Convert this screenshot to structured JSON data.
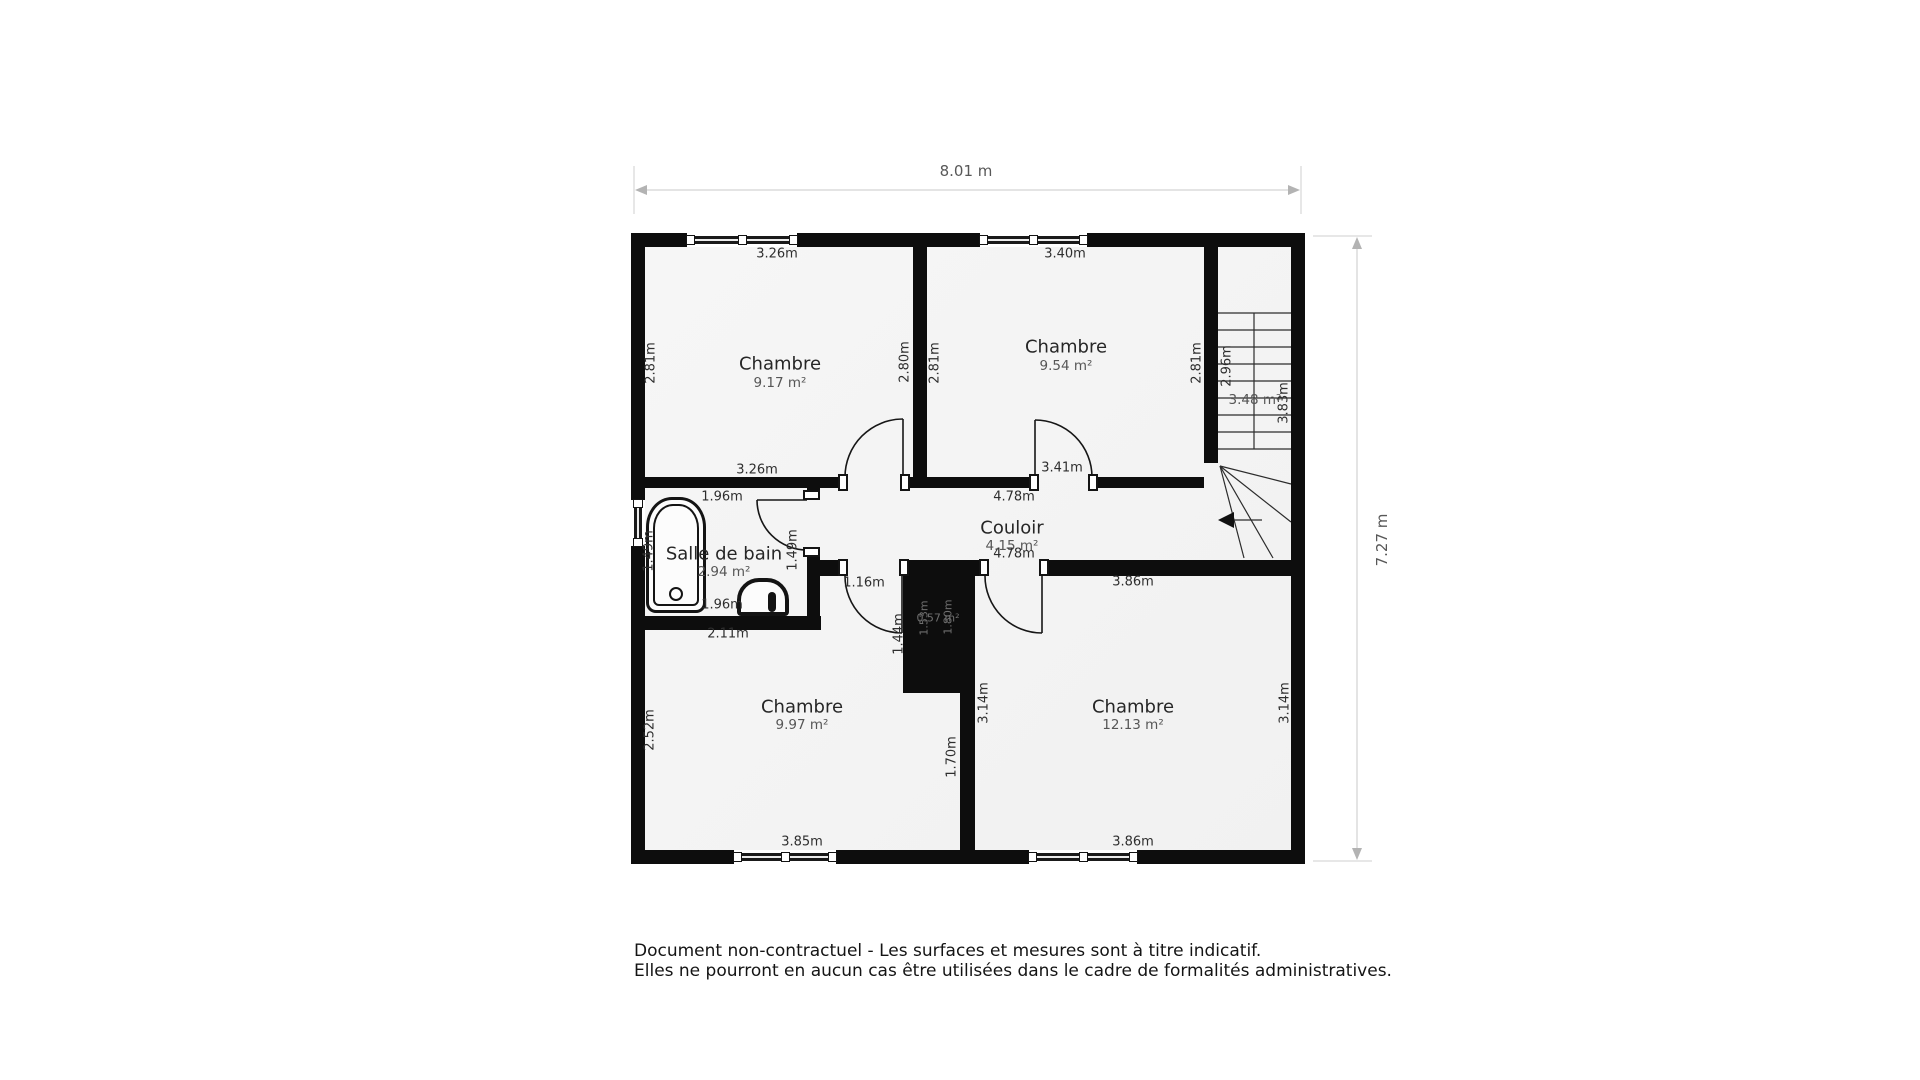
{
  "plan": {
    "dimensions": {
      "width_label": "8.01 m",
      "height_label": "7.27 m"
    },
    "rooms": [
      {
        "name": "Chambre",
        "area": "9.17 m²",
        "dims": {
          "top": "3.26m",
          "left": "2.81m",
          "right": "2.80m",
          "bottom": "3.26m"
        }
      },
      {
        "name": "Chambre",
        "area": "9.54 m²",
        "dims": {
          "top": "3.40m",
          "left": "2.81m",
          "right": "2.81m",
          "bottom": "3.41m"
        }
      },
      {
        "name": "Salle de bain",
        "area": "2.94 m²",
        "dims": {
          "top": "1.96m",
          "left": "1.49m",
          "right": "1.49m",
          "bottom": "1.96m",
          "below": "2.11m"
        }
      },
      {
        "name": "Couloir",
        "area": "4.15 m²",
        "dims": {
          "top": "4.78m",
          "bottom": "4.78m",
          "door_left": "1.16m"
        }
      },
      {
        "name": "Chambre",
        "area": "9.97 m²",
        "dims": {
          "left": "2.52m",
          "bottom": "3.85m",
          "niche_side": "1.44m",
          "wall_lower": "1.70m"
        }
      },
      {
        "name": "Chambre",
        "area": "12.13 m²",
        "dims": {
          "top": "3.86m",
          "left": "3.14m",
          "right": "3.14m",
          "bottom": "3.86m"
        }
      }
    ],
    "stairs": {
      "area": "3.48 m²",
      "left_dim": "2.96m",
      "right_dim": "3.83m"
    },
    "duct": {
      "area": "0.57 m²",
      "dim1": "1.53m",
      "dim2": "1.80m"
    }
  },
  "footer": {
    "line1": "Document non-contractuel - Les surfaces et mesures sont à titre indicatif.",
    "line2": "Elles ne pourront en aucun cas être utilisées dans le cadre de formalités administratives."
  }
}
